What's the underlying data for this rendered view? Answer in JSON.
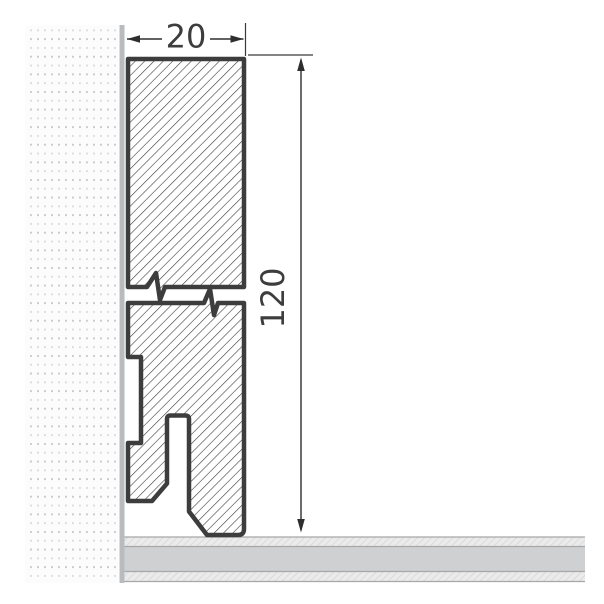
{
  "dimensions": {
    "width_label": "20",
    "height_label": "120"
  },
  "colors": {
    "background": "#ffffff",
    "board_outline": "#3d3d3d",
    "board_hatch": "#3c3c3c",
    "dimension_ink": "#2e2e2e",
    "wall_strip": "#b9bcbe",
    "wall_dot_dark": "#c9c9c9",
    "wall_dot_light": "#dcdcdc",
    "wall_background": "#fcfcfc",
    "floor_base": "#cfd0d2",
    "floor_hatch_background": "#ebebeb",
    "floor_hatch_line": "#d4d4d4",
    "floor_border": "#a7a7a7"
  }
}
